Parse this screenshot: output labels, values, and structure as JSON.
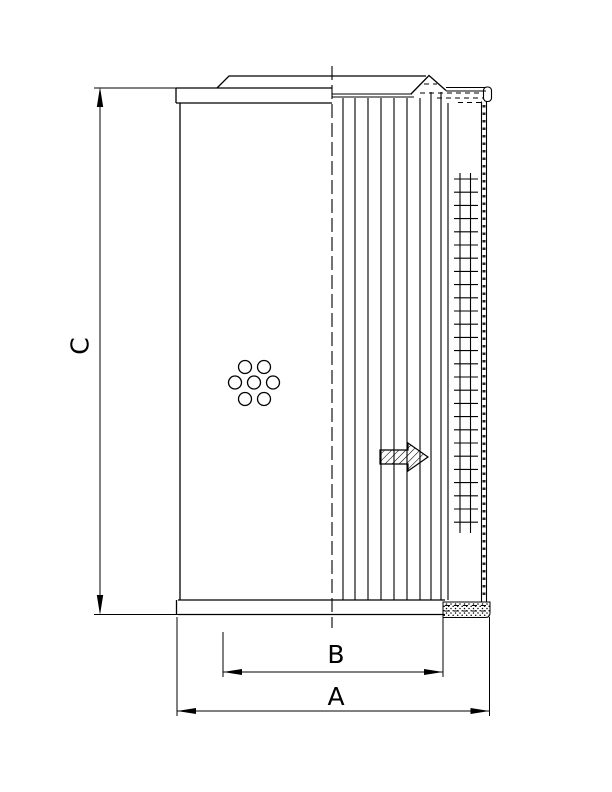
{
  "page": {
    "background_color": "#ffffff",
    "line_color": "#000000",
    "width": 612,
    "height": 792
  },
  "drawing": {
    "type": "technical-drawing",
    "subject": "filter-element-side-section-view",
    "dimensions": {
      "C": {
        "label": "C",
        "orientation": "vertical",
        "position": "left"
      },
      "B": {
        "label": "B",
        "orientation": "horizontal",
        "position": "bottom-inner"
      },
      "A": {
        "label": "A",
        "orientation": "horizontal",
        "position": "bottom-outer"
      }
    },
    "features": {
      "flow_arrow": {
        "direction": "right",
        "style": "diagonal-hatched"
      },
      "drain_holes": {
        "count": 7,
        "pattern": "hex-cluster"
      },
      "pleat_count": 10,
      "mesh_rows": 27,
      "outer_wrap": "speckled-strip",
      "centerline": "dashed"
    },
    "geometry": {
      "pleats": {
        "xs": [
          343,
          355,
          368,
          381,
          394,
          407,
          420,
          431,
          441,
          448
        ],
        "y_tops": [
          98,
          98,
          98,
          98,
          98,
          98,
          98,
          92,
          92,
          103
        ],
        "y_bottom": 600
      },
      "mesh": {
        "x1": 454,
        "x2": 478,
        "col_xs": [
          460,
          470.5
        ],
        "col_y_top": 173,
        "col_y_bottom": 533,
        "row_y_start": 179,
        "row_step": 13.2,
        "row_count": 27
      },
      "holes": {
        "radius": 6.5,
        "centers": [
          [
            245,
            367
          ],
          [
            264,
            367
          ],
          [
            235,
            382.5
          ],
          [
            254,
            382.5
          ],
          [
            273,
            382.5
          ],
          [
            245,
            399
          ],
          [
            264,
            399
          ]
        ]
      }
    }
  }
}
